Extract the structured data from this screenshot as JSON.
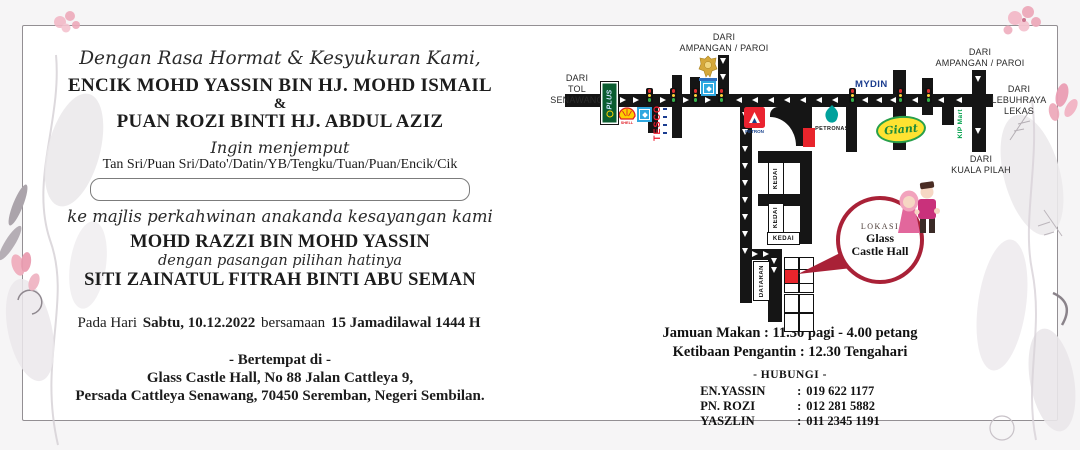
{
  "invitation": {
    "opening": "Dengan Rasa Hormat & Kesyukuran Kami,",
    "father_name": "ENCIK MOHD YASSIN BIN HJ. MOHD ISMAIL",
    "ampersand": "&",
    "mother_name": "PUAN ROZI BINTI HJ. ABDUL AZIZ",
    "invite_phrase": "Ingin menjemput",
    "honorifics": "Tan Sri/Puan Sri/Dato'/Datin/YB/Tengku/Tuan/Puan/Encik/Cik",
    "guest_name_value": "",
    "occasion_phrase": "ke majlis perkahwinan anakanda kesayangan kami",
    "groom_name": "MOHD RAZZI BIN MOHD YASSIN",
    "partner_phrase": "dengan pasangan pilihan hatinya",
    "bride_name": "SITI ZAINATUL FITRAH BINTI ABU SEMAN",
    "date_prefix": "Pada Hari",
    "date_value": "Sabtu, 10.12.2022",
    "date_conjunction": "bersamaan",
    "date_hijri": "15 Jamadilawal 1444 H",
    "venue_heading": "- Bertempat di -",
    "venue_line1": "Glass Castle Hall, No 88 Jalan Cattleya 9,",
    "venue_line2": "Persada Cattleya Senawang, 70450 Seremban, Negeri Sembilan."
  },
  "map": {
    "from_toll": {
      "l1": "DARI",
      "l2": "TOL",
      "l3": "SENAWANG"
    },
    "from_ampangan_top": {
      "l1": "DARI",
      "l2": "AMPANGAN / PAROI"
    },
    "from_ampangan_right": {
      "l1": "DARI",
      "l2": "AMPANGAN / PAROI"
    },
    "from_lekas": {
      "l1": "DARI",
      "l2": "LEBUHRAYA",
      "l3": "LEKAS"
    },
    "from_kuala_pilah": {
      "l1": "DARI",
      "l2": "KUALA PILAH"
    },
    "landmarks": {
      "plus": "PLUS",
      "shell": "SHELL",
      "tesco": "TESCO",
      "petron": "PETRON",
      "petronas": "PETRONAS",
      "mydin": "MYDIN",
      "giant": "Giant",
      "kipmart": "KIP Mart"
    },
    "shop_label": "KEDAI",
    "square_label": "DATARAN",
    "callout": {
      "heading": "LOKASI",
      "venue_l1": "Glass",
      "venue_l2": "Castle Hall"
    }
  },
  "schedule": {
    "meal_line": "Jamuan Makan : 11.30 pagi - 4.00 petang",
    "arrival_line": "Ketibaan Pengantin : 12.30 Tengahari",
    "contact_heading": "- HUBUNGI -",
    "contacts": [
      {
        "name": "EN.YASSIN",
        "phone": "019 622 1177"
      },
      {
        "name": "PN. ROZI",
        "phone": "012 281 5882"
      },
      {
        "name": "YASZLIN",
        "phone": "011 2345 1191"
      }
    ]
  }
}
